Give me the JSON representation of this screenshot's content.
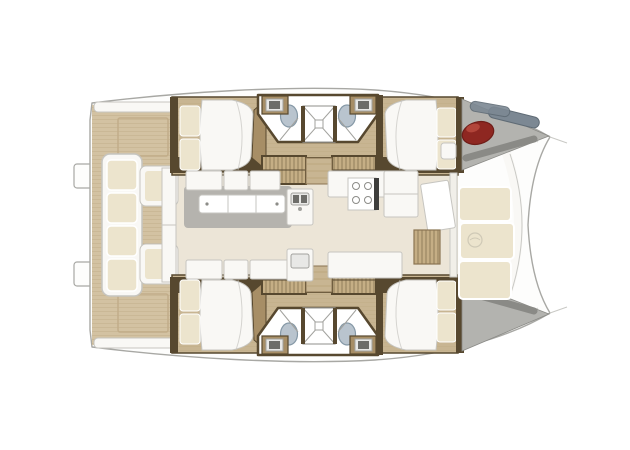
{
  "figure": {
    "type": "floor_plan",
    "subject": "Catamaran yacht deck plan, top-down view, bows pointing right",
    "summary": {
      "double_berths": 4,
      "toilets": 4,
      "washbasins": 4,
      "showers": 2,
      "companionway_steps": 4,
      "saloon_tables": 1,
      "aft_cockpit_benches": 1,
      "forward_lounges": 1,
      "red_fenders": 1
    }
  },
  "palette": {
    "bg": "#ffffff",
    "hull_fill": "#fdfdfc",
    "hull_stroke": "#a8a8a4",
    "hull_inner_line": "#c9c9c5",
    "deck_wood": "#d3c2a2",
    "deck_plank_line": "#c2ad89",
    "sole_wood": "#c8b592",
    "sole_line": "#bba87f",
    "wall_dark": "#57482f",
    "wall_mid": "#8a7452",
    "cabinet_brown": "#a78e66",
    "steps_fill": "#c5ae85",
    "steps_line": "#6e5c3e",
    "saloon_floor": "#ece5d7",
    "furniture_white": "#f9f8f5",
    "furniture_stroke": "#c6c5c0",
    "cushion_cream": "#ece4cd",
    "cushion_edge": "#ffffff",
    "shadow_gray": "#b5b3ae",
    "table_white": "#ffffff",
    "toilet_blue": "#b9c4ce",
    "toilet_stroke": "#8598a6",
    "shower_line": "#a2a29e",
    "sink_basin": "#e8e8e6",
    "sink_dark": "#6d6d69",
    "stove_dark": "#3e3e3c",
    "burner_gray": "#8c8c88",
    "bow_gray": "#b3b3af",
    "bow_band_gray": "#8a8a86",
    "fender_red": "#8e2721",
    "fender_red_hi": "#b2453a",
    "fender_edge": "#6f1d18",
    "rope_gray": "#7c8893",
    "rope_edge": "#5f6b75",
    "emblem_gray": "#cfc9b6",
    "glass_pane": "#f1efe9"
  }
}
